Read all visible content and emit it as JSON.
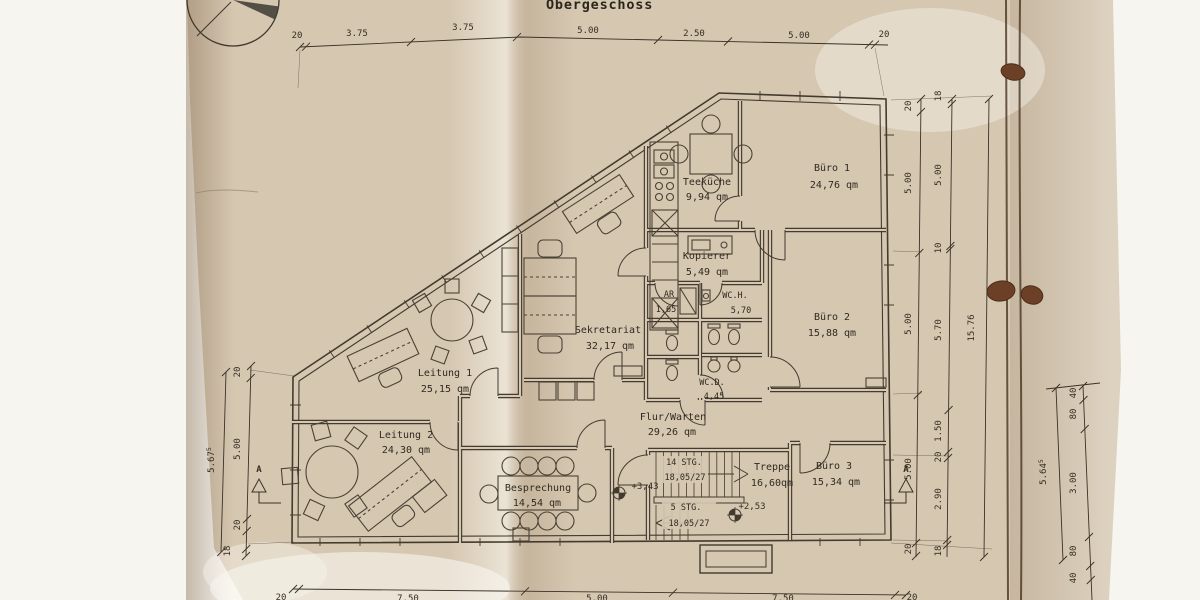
{
  "title": "Obergeschoss",
  "rooms": {
    "teekueche": {
      "name": "Teeküche",
      "area": "9,94 qm"
    },
    "buero1": {
      "name": "Büro 1",
      "area": "24,76 qm"
    },
    "kopierer": {
      "name": "Kopierer",
      "area": "5,49 qm"
    },
    "abstellraum": {
      "name": "AR",
      "area": "1,65"
    },
    "wc_herren": {
      "name": "WC.H.",
      "area": "5,70"
    },
    "buero2": {
      "name": "Büro 2",
      "area": "15,88 qm"
    },
    "sekretariat": {
      "name": "Sekretariat",
      "area": "32,17 qm"
    },
    "wc_damen": {
      "name": "WC.D.",
      "area": "4,45"
    },
    "leitung1": {
      "name": "Leitung 1",
      "area": "25,15 qm"
    },
    "flur": {
      "name": "Flur/Warten",
      "area": "29,26 qm"
    },
    "leitung2": {
      "name": "Leitung 2",
      "area": "24,30 qm"
    },
    "besprechung": {
      "name": "Besprechung",
      "area": "14,54 qm"
    },
    "treppe": {
      "name": "Treppe",
      "area": "16,60qm"
    },
    "buero3": {
      "name": "Büro 3",
      "area": "15,34 qm"
    }
  },
  "stairs": {
    "up": {
      "steps": "14 STG.",
      "riser": "18,05/27"
    },
    "down": {
      "steps": "5 STG.",
      "riser": "18,05/27"
    },
    "level_upper": "+3,43",
    "level_mid": "+2,53"
  },
  "dimensions": {
    "top": [
      "20",
      "3.75",
      "3.75",
      "5.00",
      "2.50",
      "5.00",
      "20"
    ],
    "right_inner": [
      "20",
      "5.00",
      "5.00",
      "5.00",
      "20"
    ],
    "right_middle": [
      "18",
      "5.00",
      "10",
      "5.70",
      "1.50",
      "20",
      "2.90",
      "18"
    ],
    "right_total": "15.76",
    "left_inner": [
      "20",
      "5.00",
      "20",
      "18"
    ],
    "left_total": {
      "value": "5.67",
      "sup": "5"
    },
    "bottom": [
      "20",
      "7.50",
      "5.00",
      "7.50",
      "20"
    ],
    "sheet2_total": {
      "value": "5.64",
      "sup": "5"
    },
    "sheet2_chain": [
      "40",
      "80",
      "3.00",
      "80",
      "40"
    ]
  },
  "section_marker": "A"
}
